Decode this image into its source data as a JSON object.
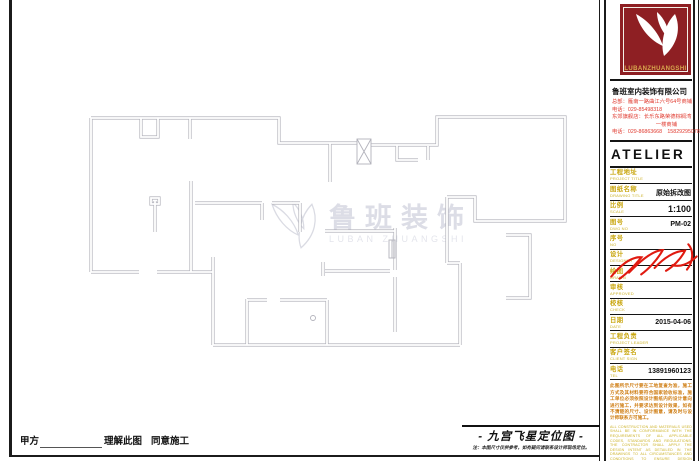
{
  "plan": {
    "drawing_type": "floor-plan-demolition",
    "wall_color": "#b3b3bc"
  },
  "watermark": {
    "cn": "鲁班装饰",
    "en": "LUBAN ZHUANGSHI"
  },
  "approval": {
    "party_a_label": "甲方",
    "understand_label": "理解此图",
    "agree_label": "同意施工"
  },
  "fengshui": {
    "title": "- 九宫飞星定位图 -",
    "note": "注：本图尺寸仅供参考，如有疑问请联系设计师现场定位。"
  },
  "logo": {
    "word": "LUBANZHUANGSHI",
    "bg": "#8e1f23",
    "gold": "#d8a84e"
  },
  "company": {
    "name": "鲁班室内装饰有限公司",
    "line1": "总部：雁南一路曲江六号64号商铺",
    "line2": "电话：029-85498318",
    "line3": "东郊旗舰店：长乐东路荣德棕榈湾",
    "line4": "一楼商铺",
    "line5": "电话：029-86863668　15829295078"
  },
  "sidebar": {
    "atelier": "ATELIER",
    "rows": [
      {
        "cn": "工程地址",
        "en": "PROJECT TITLE",
        "value": ""
      },
      {
        "cn": "图纸名称",
        "en": "DRAWING TITLE",
        "value": "原始拆改图"
      },
      {
        "cn": "比例",
        "en": "SCALE",
        "value": "1:100"
      },
      {
        "cn": "图号",
        "en": "DWG NO",
        "value": "PM-02"
      },
      {
        "cn": "序号",
        "en": "NO",
        "value": ""
      },
      {
        "cn": "设计",
        "en": "DESIGNER",
        "value": ""
      },
      {
        "cn": "绘图",
        "en": "DRAWN",
        "value": ""
      },
      {
        "cn": "审核",
        "en": "APPROVED",
        "value": ""
      },
      {
        "cn": "校核",
        "en": "CHECK",
        "value": ""
      },
      {
        "cn": "日期",
        "en": "DATE",
        "value": "2015-04-06"
      },
      {
        "cn": "工程负责",
        "en": "PROJECT LEADER",
        "value": ""
      },
      {
        "cn": "客户签名",
        "en": "CLIENT SIGN",
        "value": ""
      },
      {
        "cn": "电话",
        "en": "TEL",
        "value": "13891960123"
      }
    ],
    "disclaimer_cn": "此图所示尺寸要在工地复查为准，施工方式及其材料要符合国家验收标准，施工单位必须依照设计图纸内的设计意向进行施工，并要求达到设计效果，如有不清楚的尺寸、设计图意，请及时与设计师联系方可施工。",
    "disclaimer_en": "ALL CONSTRUCTION AND MATERIALS USED SHALL BE IN CONFORMANCE WITH THE REQUIREMENTS OF ALL APPLICABLE CODES, STANDARDS AND REGULATIONS. THE CONTRACTOR SHALL APPLY THE DESIGN INTENT AS DETAILED IN THE DRAWINGS TO ALL CIRCUMSTANCES AND CONDITIONS TO ENSURE DESIGN CONSISTENCY."
  }
}
